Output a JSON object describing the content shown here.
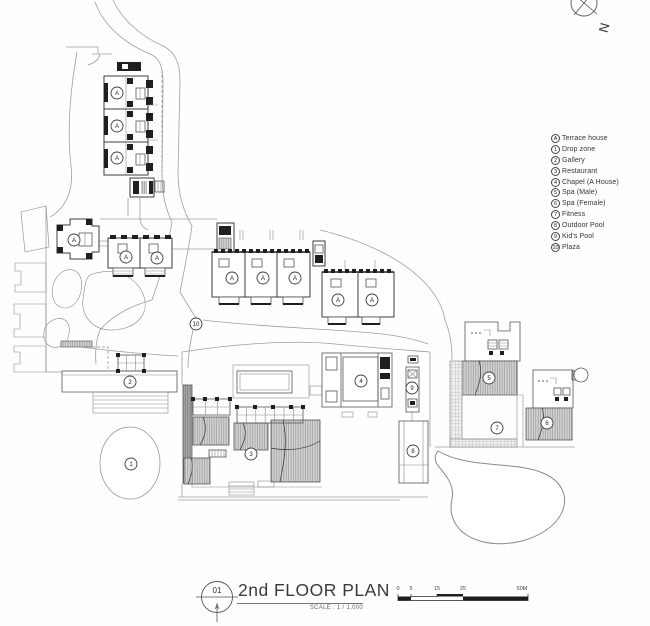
{
  "colors": {
    "line": "#8a8a8a",
    "wall": "#3c3c3c",
    "roof_fill": "#d2d2d2",
    "black": "#1f1f1f"
  },
  "north": {
    "label": "N"
  },
  "legend": {
    "items": [
      {
        "key": "A",
        "label": "Terrace house"
      },
      {
        "key": "1",
        "label": "Drop zone"
      },
      {
        "key": "2",
        "label": "Gallery"
      },
      {
        "key": "3",
        "label": "Restaurant"
      },
      {
        "key": "4",
        "label": "Chapel (A House)"
      },
      {
        "key": "5",
        "label": "Spa (Male)"
      },
      {
        "key": "6",
        "label": "Spa (Female)"
      },
      {
        "key": "7",
        "label": "Fitness"
      },
      {
        "key": "8",
        "label": "Outdoor Pool"
      },
      {
        "key": "9",
        "label": "Kid's Pool"
      },
      {
        "key": "10",
        "label": "Plaza"
      }
    ]
  },
  "title_block": {
    "sheet_number": "01",
    "sheet_letter": "A",
    "title": "2nd FLOOR PLAN",
    "scale_label": "SCALE : 1 / 1,000"
  },
  "scale_bar": {
    "tick_labels": [
      "0",
      "5",
      "15",
      "25",
      "50M"
    ]
  },
  "plan": {
    "markers": [
      {
        "label": "A",
        "x": 117,
        "y": 93
      },
      {
        "label": "A",
        "x": 117,
        "y": 126
      },
      {
        "label": "A",
        "x": 117,
        "y": 158
      },
      {
        "label": "A",
        "x": 74,
        "y": 240
      },
      {
        "label": "A",
        "x": 126,
        "y": 257
      },
      {
        "label": "A",
        "x": 157,
        "y": 258
      },
      {
        "label": "A",
        "x": 232,
        "y": 278
      },
      {
        "label": "A",
        "x": 263,
        "y": 278
      },
      {
        "label": "A",
        "x": 295,
        "y": 278
      },
      {
        "label": "A",
        "x": 338,
        "y": 300
      },
      {
        "label": "A",
        "x": 372,
        "y": 300
      },
      {
        "label": "1",
        "x": 131,
        "y": 464
      },
      {
        "label": "2",
        "x": 130,
        "y": 382
      },
      {
        "label": "3",
        "x": 251,
        "y": 454
      },
      {
        "label": "4",
        "x": 361,
        "y": 381
      },
      {
        "label": "5",
        "x": 489,
        "y": 378
      },
      {
        "label": "6",
        "x": 547,
        "y": 423
      },
      {
        "label": "7",
        "x": 497,
        "y": 428
      },
      {
        "label": "8",
        "x": 413,
        "y": 451
      },
      {
        "label": "9",
        "x": 412,
        "y": 388
      },
      {
        "label": "10",
        "x": 196,
        "y": 324
      }
    ]
  }
}
